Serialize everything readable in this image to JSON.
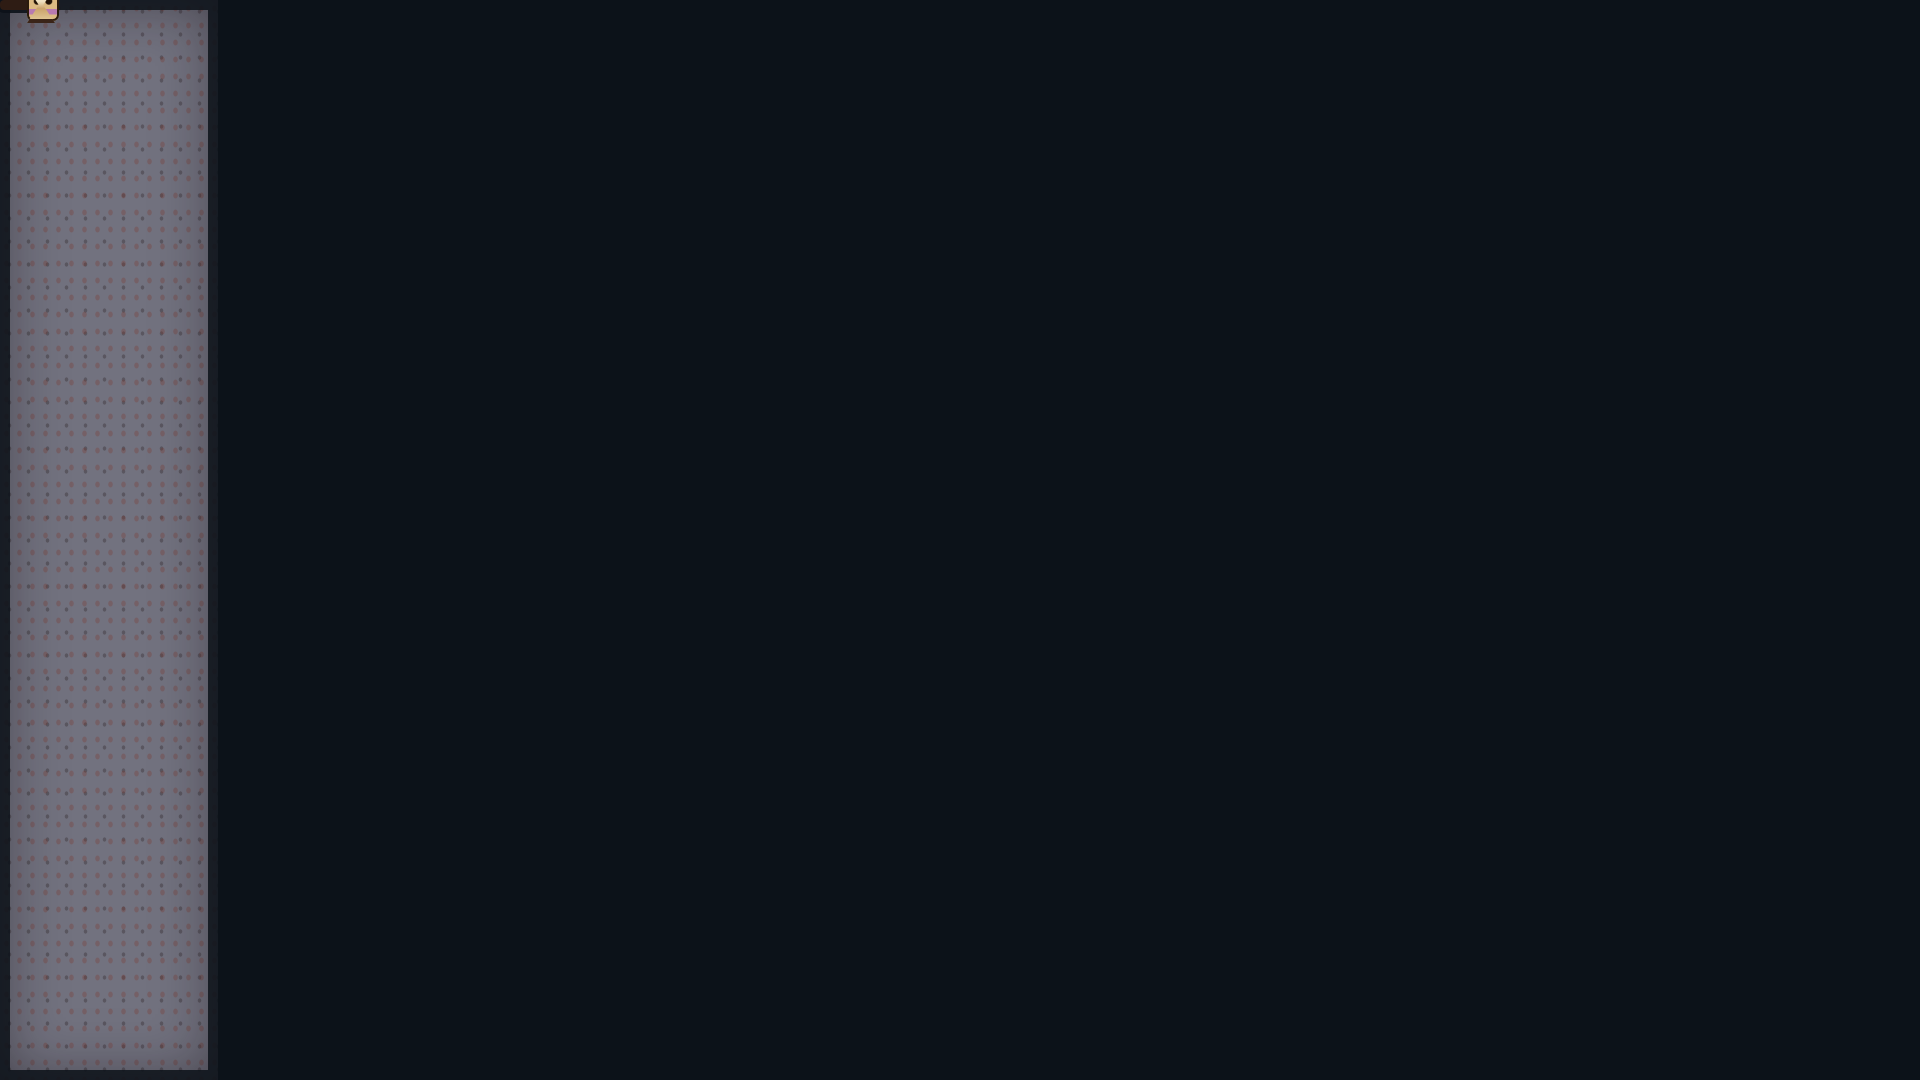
{
  "hud": {
    "counters": [
      {
        "icon": "skull-icon",
        "value": "0003"
      },
      {
        "icon": "mummy-face-icon",
        "value": "0012"
      },
      {
        "icon": "ankh-icon",
        "value": "0004"
      },
      {
        "icon": "pharaoh-face-icon",
        "value": "0021"
      }
    ],
    "wave_label": "Oleada: 2 / 2",
    "hourglass_icon": "hourglass-icon"
  },
  "colors": {
    "background": "#0c1219",
    "brick": "#e09a26",
    "brick_highlight": "#ffd94e",
    "brick_mortar": "#2a1a0b",
    "panel": "#72727f",
    "glyph": "#5c2a24",
    "hud_fill": "#bd9058",
    "hud_border": "#2e1c14",
    "blood": "#c31616",
    "spike": "#f2a226",
    "spider": "#2e6b2e",
    "lock": "#d42a22"
  },
  "panels_meta": {
    "numeral": "2"
  },
  "panels": [
    {
      "side": "left",
      "x": 0,
      "y": 0,
      "w": 218,
      "h": 1080,
      "dividers": [
        215,
        445,
        668,
        882
      ],
      "glyphs": [
        {
          "t": "g2",
          "x": 50,
          "y": 75,
          "w": 70,
          "h": 110
        },
        {
          "t": "staff",
          "x": 150,
          "y": 55,
          "w": 14,
          "h": 150
        },
        {
          "t": "staff",
          "x": 178,
          "y": 35,
          "w": 10,
          "h": 185
        },
        {
          "t": "bowl",
          "x": 28,
          "y": 140,
          "w": 150,
          "h": 55
        },
        {
          "t": "bird",
          "x": 25,
          "y": 258,
          "w": 85,
          "h": 75
        },
        {
          "t": "cshape",
          "x": 120,
          "y": 280,
          "w": 70,
          "h": 90
        },
        {
          "t": "bars",
          "x": 40,
          "y": 355,
          "w": 130,
          "h": 70
        },
        {
          "t": "bars",
          "x": 35,
          "y": 468,
          "w": 120,
          "h": 75
        },
        {
          "t": "bird",
          "x": 55,
          "y": 560,
          "w": 85,
          "h": 65
        },
        {
          "t": "gate",
          "x": 45,
          "y": 700,
          "w": 125,
          "h": 160
        },
        {
          "t": "poppy",
          "x": 28,
          "y": 903,
          "w": 42,
          "h": 165
        },
        {
          "t": "poppy",
          "x": 88,
          "y": 903,
          "w": 42,
          "h": 165
        },
        {
          "t": "poppy",
          "x": 148,
          "y": 903,
          "w": 42,
          "h": 165
        }
      ]
    },
    {
      "side": "right",
      "x": 1640,
      "y": 0,
      "w": 280,
      "h": 1080,
      "dividers": [
        222,
        440,
        673,
        880
      ],
      "glyphs": [
        {
          "t": "g2",
          "x": 1685,
          "y": 35,
          "w": 70,
          "h": 105
        },
        {
          "t": "bars",
          "x": 1790,
          "y": 25,
          "w": 100,
          "h": 150
        },
        {
          "t": "bowl",
          "x": 1688,
          "y": 150,
          "w": 170,
          "h": 52
        },
        {
          "t": "legs",
          "x": 1700,
          "y": 255,
          "w": 190,
          "h": 165
        },
        {
          "t": "staff",
          "x": 1662,
          "y": 255,
          "w": 12,
          "h": 155
        },
        {
          "t": "cshape",
          "x": 1755,
          "y": 555,
          "w": 105,
          "h": 105
        },
        {
          "t": "staff",
          "x": 1700,
          "y": 475,
          "w": 14,
          "h": 175
        },
        {
          "t": "pylons",
          "x": 1675,
          "y": 695,
          "w": 210,
          "h": 175
        },
        {
          "t": "poppy",
          "x": 1668,
          "y": 900,
          "w": 46,
          "h": 170
        },
        {
          "t": "poppy",
          "x": 1742,
          "y": 900,
          "w": 46,
          "h": 170
        },
        {
          "t": "poppy",
          "x": 1816,
          "y": 900,
          "w": 46,
          "h": 170
        }
      ]
    }
  ],
  "scene": {
    "lock_letter": "S",
    "backdrops": [
      {
        "x": 1598,
        "y": 352,
        "w": 55,
        "h": 126
      }
    ],
    "platforms": [
      {
        "x": 218,
        "y": 0,
        "w": 707,
        "h": 48,
        "v": "ceiling"
      },
      {
        "x": 993,
        "y": 0,
        "w": 647,
        "h": 48,
        "v": "ceiling"
      },
      {
        "x": 218,
        "y": 0,
        "w": 96,
        "h": 1080
      },
      {
        "x": 314,
        "y": 48,
        "w": 54,
        "h": 170
      },
      {
        "x": 314,
        "y": 148,
        "w": 406,
        "h": 80
      },
      {
        "x": 843,
        "y": 48,
        "w": 234,
        "h": 120
      },
      {
        "x": 1085,
        "y": 143,
        "w": 510,
        "h": 87
      },
      {
        "x": 563,
        "y": 233,
        "w": 474,
        "h": 127
      },
      {
        "x": 1235,
        "y": 230,
        "w": 185,
        "h": 130
      },
      {
        "x": 1325,
        "y": 338,
        "w": 137,
        "h": 92
      },
      {
        "x": 1595,
        "y": 0,
        "w": 45,
        "h": 390
      },
      {
        "x": 1530,
        "y": 38,
        "w": 110,
        "h": 60
      },
      {
        "x": 1640,
        "y": 390,
        "w": 70,
        "h": 690
      },
      {
        "x": 218,
        "y": 478,
        "w": 687,
        "h": 82
      },
      {
        "x": 965,
        "y": 478,
        "w": 690,
        "h": 82
      },
      {
        "x": 218,
        "y": 560,
        "w": 200,
        "h": 36
      },
      {
        "x": 408,
        "y": 337,
        "w": 104,
        "h": 30
      },
      {
        "x": 430,
        "y": 672,
        "w": 475,
        "h": 66
      },
      {
        "x": 965,
        "y": 672,
        "w": 195,
        "h": 66
      },
      {
        "x": 1160,
        "y": 745,
        "w": 270,
        "h": 100
      },
      {
        "x": 1430,
        "y": 795,
        "w": 230,
        "h": 50
      },
      {
        "x": 218,
        "y": 905,
        "w": 502,
        "h": 55
      },
      {
        "x": 883,
        "y": 860,
        "w": 197,
        "h": 45
      },
      {
        "x": 988,
        "y": 900,
        "w": 92,
        "h": 120
      },
      {
        "x": 413,
        "y": 962,
        "w": 112,
        "h": 46
      },
      {
        "x": 1035,
        "y": 960,
        "w": 455,
        "h": 50
      },
      {
        "x": 218,
        "y": 1008,
        "w": 1492,
        "h": 72
      },
      {
        "x": 1430,
        "y": 958,
        "w": 280,
        "h": 122
      },
      {
        "x": 1458,
        "y": 723,
        "w": 55,
        "h": 40
      }
    ],
    "pillars": [
      {
        "x": 425,
        "y": 228,
        "w": 20,
        "h": 250
      },
      {
        "x": 500,
        "y": 228,
        "w": 20,
        "h": 250
      },
      {
        "x": 1061,
        "y": 230,
        "w": 22,
        "h": 130
      },
      {
        "x": 1158,
        "y": 230,
        "w": 22,
        "h": 130
      }
    ],
    "ladders": [
      {
        "x": 316,
        "y": 95,
        "w": 46,
        "h": 383
      },
      {
        "x": 368,
        "y": 228,
        "w": 44,
        "h": 250
      },
      {
        "x": 524,
        "y": 293,
        "w": 40,
        "h": 185
      },
      {
        "x": 917,
        "y": 433,
        "w": 44,
        "h": 290
      },
      {
        "x": 1195,
        "y": 233,
        "w": 44,
        "h": 245
      },
      {
        "x": 1272,
        "y": 338,
        "w": 46,
        "h": 140
      },
      {
        "x": 1553,
        "y": 97,
        "w": 44,
        "h": 381
      },
      {
        "x": 1468,
        "y": 430,
        "w": 44,
        "h": 48
      },
      {
        "x": 1605,
        "y": 352,
        "w": 48,
        "h": 126
      },
      {
        "x": 256,
        "y": 598,
        "w": 42,
        "h": 307
      },
      {
        "x": 1078,
        "y": 813,
        "w": 42,
        "h": 150
      }
    ],
    "spikes": [
      {
        "x": 290,
        "y": 966,
        "w": 122,
        "h": 44
      },
      {
        "x": 560,
        "y": 966,
        "w": 425,
        "h": 44
      },
      {
        "x": 1165,
        "y": 702,
        "w": 302,
        "h": 44
      }
    ],
    "webs": [
      {
        "x": 250,
        "y": 44,
        "w": 62,
        "h": 48,
        "side": "left"
      },
      {
        "x": 1498,
        "y": 42,
        "w": 66,
        "h": 52,
        "side": "right"
      },
      {
        "x": 473,
        "y": 78,
        "w": 72,
        "h": 64,
        "side": "left"
      },
      {
        "x": 333,
        "y": 556,
        "w": 38,
        "h": 36,
        "side": "left"
      },
      {
        "x": 1118,
        "y": 556,
        "w": 44,
        "h": 34,
        "side": "right"
      },
      {
        "x": 1130,
        "y": 745,
        "w": 32,
        "h": 50,
        "side": "left"
      },
      {
        "x": 1453,
        "y": 900,
        "w": 38,
        "h": 58,
        "side": "right"
      },
      {
        "x": 1605,
        "y": 452,
        "w": 48,
        "h": 58,
        "side": "right"
      },
      {
        "x": 255,
        "y": 933,
        "w": 38,
        "h": 30,
        "side": "left"
      }
    ],
    "torches": [
      {
        "x": 627,
        "y": 42
      },
      {
        "x": 1208,
        "y": 50
      },
      {
        "x": 1293,
        "y": 46
      },
      {
        "x": 407,
        "y": 145
      },
      {
        "x": 1423,
        "y": 236
      },
      {
        "x": 1437,
        "y": 625
      },
      {
        "x": 1212,
        "y": 864
      },
      {
        "x": 305,
        "y": 766
      }
    ],
    "spiders": [
      {
        "x": 276,
        "y": 90,
        "w": 34,
        "h": 28,
        "thread": 48
      },
      {
        "x": 1516,
        "y": 80,
        "w": 34,
        "h": 30,
        "thread": 42
      },
      {
        "x": 1122,
        "y": 608,
        "w": 36,
        "h": 32,
        "thread": 52
      },
      {
        "x": 1566,
        "y": 710,
        "w": 34,
        "h": 30,
        "thread": 92
      }
    ],
    "sprites": [
      {
        "t": "stalactite",
        "x": 926,
        "y": 0,
        "w": 70,
        "h": 118
      },
      {
        "t": "dark-pillar",
        "x": 737,
        "y": 46,
        "w": 34,
        "h": 100
      },
      {
        "t": "dark-pillar",
        "x": 1447,
        "y": 46,
        "w": 18,
        "h": 96
      },
      {
        "t": "skull-decor",
        "x": 577,
        "y": 443,
        "w": 26,
        "h": 35
      },
      {
        "t": "skull-decor",
        "x": 1080,
        "y": 441,
        "w": 26,
        "h": 37
      },
      {
        "t": "skull-decor",
        "x": 1405,
        "y": 305,
        "w": 26,
        "h": 33
      },
      {
        "t": "bone",
        "x": 527,
        "y": 462,
        "w": 18,
        "h": 16
      },
      {
        "t": "bone",
        "x": 558,
        "y": 456,
        "w": 16,
        "h": 22
      },
      {
        "t": "bone",
        "x": 676,
        "y": 460,
        "w": 20,
        "h": 18
      },
      {
        "t": "bone",
        "x": 880,
        "y": 458,
        "w": 18,
        "h": 20
      },
      {
        "t": "bone",
        "x": 1048,
        "y": 462,
        "w": 16,
        "h": 16
      },
      {
        "t": "stump",
        "x": 512,
        "y": 636,
        "w": 44,
        "h": 36
      },
      {
        "t": "stump",
        "x": 556,
        "y": 648,
        "w": 40,
        "h": 24
      },
      {
        "t": "stump",
        "x": 757,
        "y": 640,
        "w": 34,
        "h": 32
      },
      {
        "t": "mound",
        "x": 1130,
        "y": 118,
        "w": 44,
        "h": 26
      },
      {
        "t": "mound",
        "x": 1317,
        "y": 117,
        "w": 44,
        "h": 27
      },
      {
        "t": "dice",
        "x": 928,
        "y": 186,
        "w": 22,
        "h": 21
      },
      {
        "t": "dice",
        "x": 917,
        "y": 207,
        "w": 26,
        "h": 26
      },
      {
        "t": "dice",
        "x": 943,
        "y": 207,
        "w": 26,
        "h": 26
      },
      {
        "t": "dice",
        "x": 534,
        "y": 964,
        "w": 24,
        "h": 22
      },
      {
        "t": "dice",
        "x": 528,
        "y": 986,
        "w": 27,
        "h": 22
      },
      {
        "t": "chick",
        "x": 633,
        "y": 650,
        "w": 22,
        "h": 24
      },
      {
        "t": "lock",
        "x": 466,
        "y": 673,
        "w": 30,
        "h": 43
      },
      {
        "t": "lock",
        "x": 1042,
        "y": 912,
        "w": 34,
        "h": 46
      },
      {
        "t": "gem",
        "x": 1068,
        "y": 922,
        "w": 24,
        "h": 30
      },
      {
        "t": "tower-roof",
        "x": 328,
        "y": 818,
        "w": 54,
        "h": 30
      },
      {
        "t": "tower-body",
        "x": 337,
        "y": 848,
        "w": 38,
        "h": 57
      },
      {
        "t": "lock",
        "x": 342,
        "y": 862,
        "w": 28,
        "h": 38
      },
      {
        "t": "tower-roof",
        "x": 525,
        "y": 818,
        "w": 54,
        "h": 30
      },
      {
        "t": "tower-body",
        "x": 534,
        "y": 848,
        "w": 38,
        "h": 57
      },
      {
        "t": "lock",
        "x": 539,
        "y": 862,
        "w": 28,
        "h": 38
      },
      {
        "t": "crate",
        "x": 377,
        "y": 857,
        "w": 38,
        "h": 48
      },
      {
        "t": "crate",
        "x": 574,
        "y": 857,
        "w": 38,
        "h": 48
      },
      {
        "t": "crate",
        "x": 848,
        "y": 674,
        "w": 35,
        "h": 45
      },
      {
        "t": "crate",
        "x": 884,
        "y": 674,
        "w": 35,
        "h": 45
      },
      {
        "t": "crate-dark",
        "x": 1567,
        "y": 935,
        "w": 46,
        "h": 25
      },
      {
        "t": "mummy",
        "x": 263,
        "y": 248,
        "w": 30,
        "h": 42
      },
      {
        "t": "mummy",
        "x": 926,
        "y": 534,
        "w": 32,
        "h": 44
      },
      {
        "t": "mummy",
        "x": 612,
        "y": 628,
        "w": 30,
        "h": 44
      },
      {
        "t": "mummy",
        "x": 380,
        "y": 434,
        "w": 30,
        "h": 44
      },
      {
        "t": "mummy",
        "x": 1611,
        "y": 416,
        "w": 30,
        "h": 40
      },
      {
        "t": "mummy-bloody",
        "x": 448,
        "y": 926,
        "w": 34,
        "h": 36
      },
      {
        "t": "zombie",
        "x": 727,
        "y": 625,
        "w": 30,
        "h": 47
      },
      {
        "t": "ghost-white",
        "x": 652,
        "y": 604,
        "w": 30,
        "h": 48
      },
      {
        "t": "ghost-green",
        "x": 292,
        "y": 743,
        "w": 30,
        "h": 44
      },
      {
        "t": "vulture",
        "x": 452,
        "y": 638,
        "w": 32,
        "h": 30
      },
      {
        "t": "vulture",
        "x": 338,
        "y": 446,
        "w": 34,
        "h": 32
      },
      {
        "t": "swirl",
        "x": 598,
        "y": 668,
        "w": 54,
        "h": 54
      },
      {
        "t": "hive",
        "x": 452,
        "y": 383,
        "w": 38,
        "h": 52
      },
      {
        "t": "thread",
        "x": 469,
        "y": 367,
        "w": 3,
        "h": 18
      },
      {
        "t": "chain",
        "x": 1376,
        "y": 385,
        "w": 6,
        "h": 52
      },
      {
        "t": "chain",
        "x": 1404,
        "y": 385,
        "w": 6,
        "h": 52
      },
      {
        "t": "bar",
        "x": 1366,
        "y": 434,
        "w": 52,
        "h": 10
      },
      {
        "t": "brazier",
        "x": 1374,
        "y": 444,
        "w": 42,
        "h": 40
      },
      {
        "t": "skull-white",
        "x": 1382,
        "y": 456,
        "w": 24,
        "h": 26
      },
      {
        "t": "blood",
        "x": 1364,
        "y": 478,
        "w": 56,
        "h": 16
      },
      {
        "t": "blood",
        "x": 448,
        "y": 470,
        "w": 44,
        "h": 30
      },
      {
        "t": "blood",
        "x": 650,
        "y": 674,
        "w": 48,
        "h": 16
      },
      {
        "t": "tablet",
        "x": 1558,
        "y": 848,
        "w": 94,
        "h": 66
      },
      {
        "t": "orange-creature",
        "x": 1570,
        "y": 903,
        "w": 42,
        "h": 34
      },
      {
        "t": "post",
        "x": 1605,
        "y": 916,
        "w": 14,
        "h": 42
      },
      {
        "t": "slime-yellow",
        "x": 1621,
        "y": 926,
        "w": 36,
        "h": 32
      },
      {
        "t": "slime-yellow",
        "x": 1466,
        "y": 686,
        "w": 42,
        "h": 37
      },
      {
        "t": "flower",
        "x": 264,
        "y": 766,
        "w": 24,
        "h": 36
      },
      {
        "t": "barrel",
        "x": 1594,
        "y": 294,
        "w": 44,
        "h": 24
      },
      {
        "t": "tealcap",
        "x": 218,
        "y": 288,
        "w": 48,
        "h": 42
      },
      {
        "t": "speck",
        "x": 435,
        "y": 615,
        "w": 6,
        "h": 6
      },
      {
        "t": "speck",
        "x": 1040,
        "y": 583,
        "w": 6,
        "h": 6
      },
      {
        "t": "speck",
        "x": 712,
        "y": 610,
        "w": 5,
        "h": 5
      },
      {
        "t": "speck",
        "x": 262,
        "y": 520,
        "w": 5,
        "h": 5
      },
      {
        "t": "speck",
        "x": 930,
        "y": 1025,
        "w": 6,
        "h": 6
      }
    ],
    "hud_bar": {
      "x": 430,
      "y": 1037,
      "w": 1012,
      "h": 43
    }
  }
}
